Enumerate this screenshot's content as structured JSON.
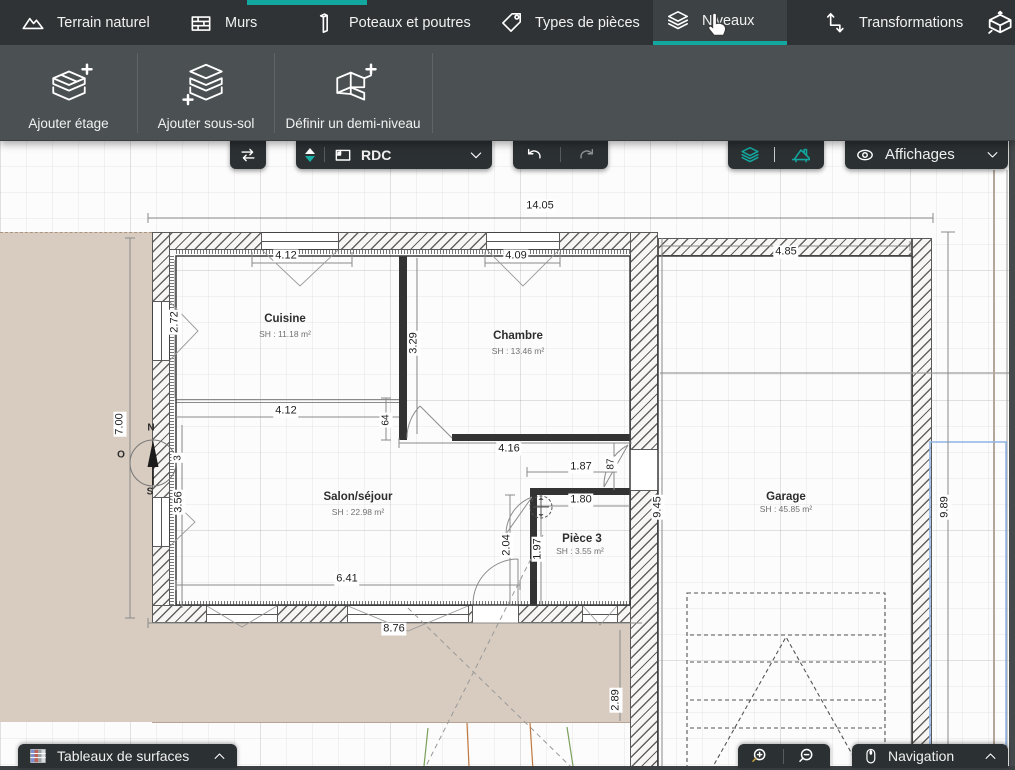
{
  "top_tabs": {
    "items": [
      {
        "label": "Terrain naturel",
        "icon": "mountain-icon"
      },
      {
        "label": "Murs",
        "icon": "bricks-icon"
      },
      {
        "label": "Poteaux et poutres",
        "icon": "column-icon"
      },
      {
        "label": "Types de pièces",
        "icon": "tag-icon"
      },
      {
        "label": "Niveaux",
        "icon": "layers-icon",
        "active": true
      },
      {
        "label": "Transformations",
        "icon": "transform-icon"
      }
    ]
  },
  "ribbon": {
    "buttons": [
      {
        "label": "Ajouter étage"
      },
      {
        "label": "Ajouter sous-sol"
      },
      {
        "label": "Définir un demi-niveau"
      }
    ]
  },
  "canvas_toolbar": {
    "level_selector": {
      "value": "RDC"
    },
    "affichages": {
      "label": "Affichages"
    }
  },
  "bottom_bar": {
    "surfaces": {
      "label": "Tableaux de surfaces"
    },
    "navigation": {
      "label": "Navigation"
    }
  },
  "floorplan": {
    "rooms": [
      {
        "name": "Cuisine",
        "area": "SH : 11.18 m²"
      },
      {
        "name": "Chambre",
        "area": "SH : 13.46 m²"
      },
      {
        "name": "Salon/séjour",
        "area": "SH : 22.98 m²"
      },
      {
        "name": "Pièce 3",
        "area": "SH : 3.55 m²"
      },
      {
        "name": "Garage",
        "area": "SH : 45.85 m²"
      }
    ],
    "dims": {
      "total_width": "14.05",
      "cuisine_window": "4.12",
      "chambre_window": "4.09",
      "garage_width": "4.85",
      "cuisine_left": "2.72",
      "chambre_height": "3.29",
      "cuisine_bottom": "4.12",
      "wall_64": "64",
      "west_height": "7.00",
      "wall_3": "3",
      "chambre_bottom": "4.16",
      "piece3_offset": "1.87",
      "door_87": "87",
      "salon_left": "3.56",
      "piece3_width": "1.80",
      "salon_door": "2.04",
      "piece3_height": "1.97",
      "salon_bottom": "6.41",
      "garage_left_height": "9.45",
      "garage_right_height": "9.89",
      "terrace_width": "8.76",
      "terrace_height": "2.89"
    },
    "compass": {
      "north": "N",
      "south": "S",
      "west": "O"
    },
    "colors": {
      "accent_teal": "#12a8a0",
      "terrace_beige": "#d8ccc0"
    }
  }
}
